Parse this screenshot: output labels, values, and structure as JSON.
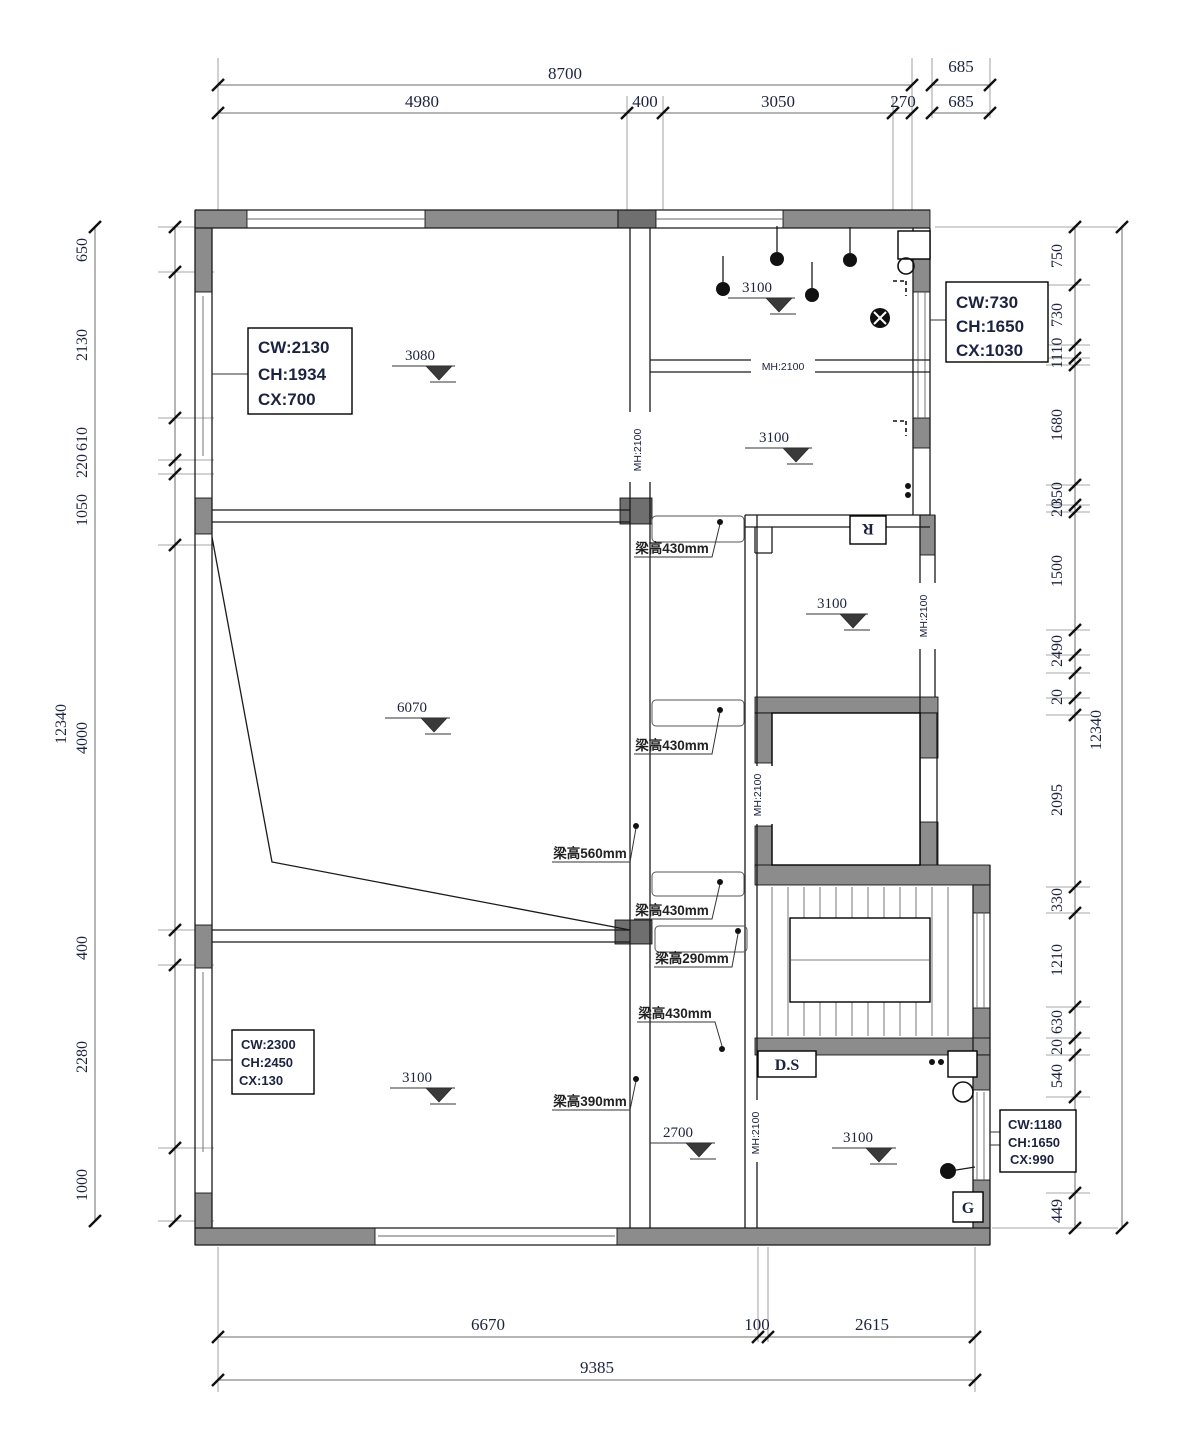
{
  "colors": {
    "wall_gray": "#8c8c8c",
    "wall_dark": "#6f6f6f",
    "line": "#1a1a1a",
    "text": "#1c2340"
  },
  "dims": {
    "top": {
      "overall": "8700",
      "offset_upper": "685",
      "segments": [
        "4980",
        "400",
        "3050",
        "270"
      ],
      "offset_lower": "685"
    },
    "bottom": {
      "segments": [
        "6670",
        "100",
        "2615"
      ],
      "overall": "9385"
    },
    "left": {
      "total": "12340",
      "segments": [
        "650",
        "2130",
        "610",
        "220",
        "1050",
        "4000",
        "400",
        "2280",
        "1000"
      ]
    },
    "right": {
      "total": "12340",
      "segments": [
        "750",
        "730",
        "1110",
        "1680",
        "350",
        "20",
        "1500",
        "2490",
        "20",
        "2095",
        "330",
        "1210",
        "630",
        "20",
        "540",
        "1191",
        "449"
      ]
    }
  },
  "window_tags": {
    "top_left": [
      "CW:2130",
      "CH:1934",
      "CX:700"
    ],
    "top_right": [
      "CW:730",
      "CH:1650",
      "CX:1030"
    ],
    "bottom_left": [
      "CW:2300",
      "CH:2450",
      "CX:130"
    ],
    "bottom_right": [
      "CW:1180",
      "CH:1650",
      "CX:990"
    ]
  },
  "elevations": {
    "room_top_left": "3080",
    "room_top_right_1": "3100",
    "room_top_right_2": "3100",
    "room_mid_right": "3100",
    "room_big": "6070",
    "room_bottom_left": "3100",
    "corridor": "2700",
    "room_bottom_right": "3100"
  },
  "beam_labels": [
    "梁高430mm",
    "梁高430mm",
    "梁高560mm",
    "梁高430mm",
    "梁高290mm",
    "梁高430mm",
    "梁高390mm"
  ],
  "door_labels": [
    "MH:2100",
    "MH:2100",
    "MH:2100",
    "MH:2100",
    "MH:2100"
  ],
  "room_tags": {
    "r": "R",
    "ds": "D.S",
    "g": "G"
  }
}
